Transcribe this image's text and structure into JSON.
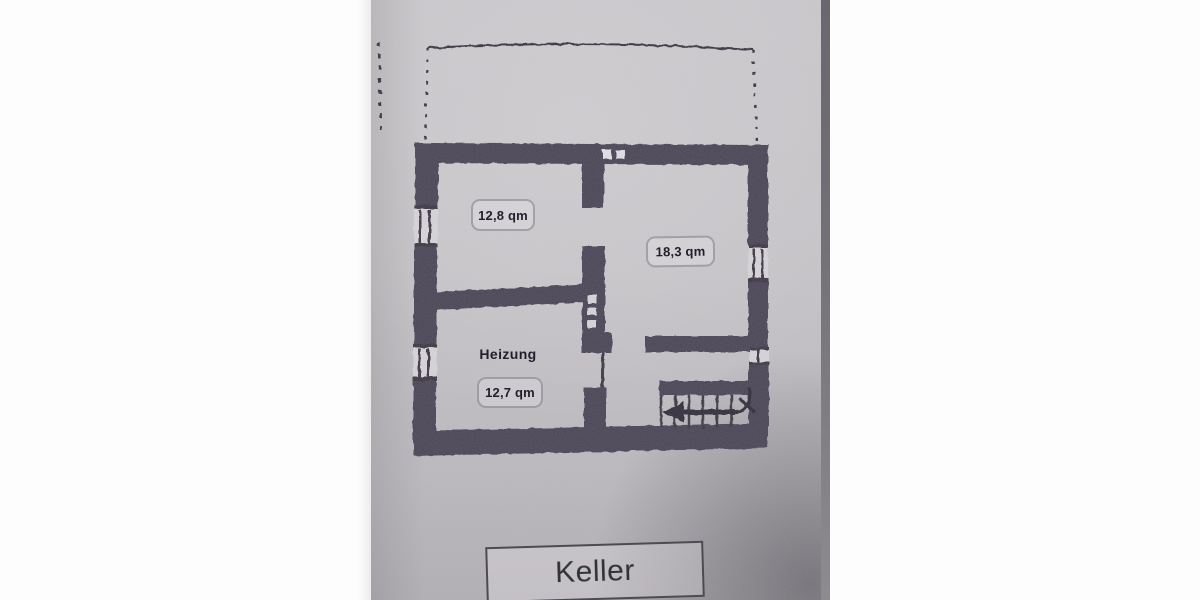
{
  "caption": {
    "label": "Keller"
  },
  "floor_plan": {
    "rooms": [
      {
        "area": "12,8 qm"
      },
      {
        "area": "18,3 qm"
      },
      {
        "name": "Heizung",
        "area": "12,7 qm"
      }
    ],
    "colors": {
      "wall": "#474352",
      "ink": "#3a3642",
      "paper": "#c6c3c8",
      "window_opening": "#d7d4d9",
      "margin": "#fdfdfd"
    }
  }
}
